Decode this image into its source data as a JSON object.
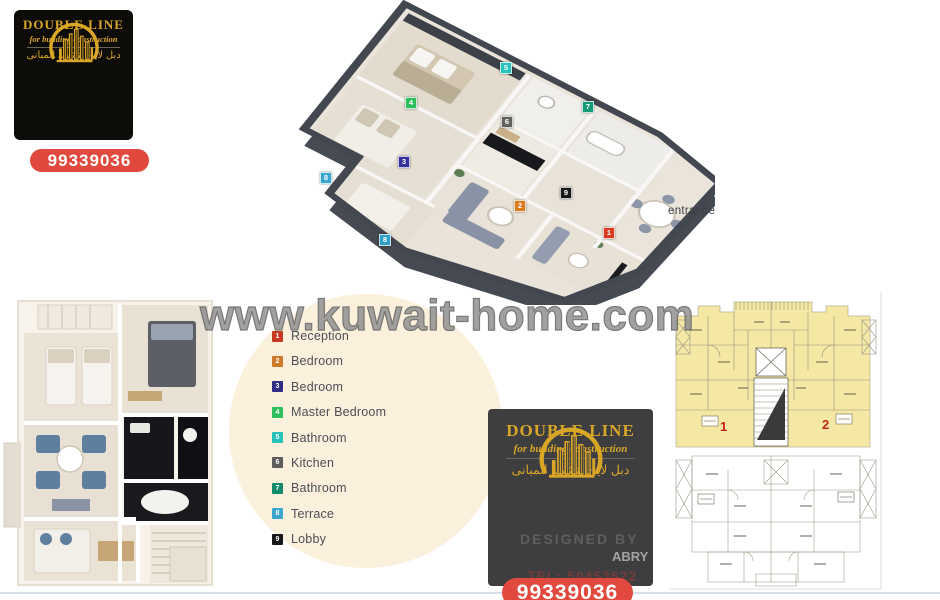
{
  "brand": {
    "name": "DOUBLE LINE",
    "tagline": "for building construction",
    "tagline_arabic": "دبل لاين لتشييد المبانى",
    "phone": "99339036",
    "gold_color": "#d9a625",
    "phone_bg_color": "#e2493e"
  },
  "watermark": "www.kuwait-home.com",
  "iso_plan": {
    "entrance_label": "entrance",
    "markers": [
      {
        "num": "1",
        "room": "Reception",
        "color": "#d93a20",
        "x": 609,
        "y": 233
      },
      {
        "num": "2",
        "room": "Bedroom",
        "color": "#dd7b22",
        "x": 520,
        "y": 206
      },
      {
        "num": "3",
        "room": "Bedroom",
        "color": "#33309e",
        "x": 404,
        "y": 162
      },
      {
        "num": "4",
        "room": "Master Bedroom",
        "color": "#2fbe5d",
        "x": 411,
        "y": 103
      },
      {
        "num": "5",
        "room": "Bathroom",
        "color": "#27c3bb",
        "x": 506,
        "y": 68
      },
      {
        "num": "6",
        "room": "Kitchen",
        "color": "#63625f",
        "x": 507,
        "y": 122
      },
      {
        "num": "7",
        "room": "Bathroom",
        "color": "#159a78",
        "x": 588,
        "y": 107
      },
      {
        "num": "8",
        "room": "Terrace",
        "color": "#3ba6d0",
        "x": 326,
        "y": 178
      },
      {
        "num": "8",
        "room": "Terrace",
        "color": "#2f9fc9",
        "x": 385,
        "y": 240
      },
      {
        "num": "9",
        "room": "Lobby",
        "color": "#17171a",
        "x": 566,
        "y": 193
      }
    ]
  },
  "legend": {
    "items": [
      {
        "num": "1",
        "label": "Reception",
        "color": "#c53a20"
      },
      {
        "num": "2",
        "label": "Bedroom",
        "color": "#cd7a28"
      },
      {
        "num": "3",
        "label": "Bedroom",
        "color": "#2f2c86"
      },
      {
        "num": "4",
        "label": "Master Bedroom",
        "color": "#2fbe5d"
      },
      {
        "num": "5",
        "label": "Bathroom",
        "color": "#27c3bb"
      },
      {
        "num": "6",
        "label": "Kitchen",
        "color": "#5d5c59"
      },
      {
        "num": "7",
        "label": "Bathroom",
        "color": "#128a6c"
      },
      {
        "num": "8",
        "label": "Terrace",
        "color": "#3ba6d0"
      },
      {
        "num": "9",
        "label": "Lobby",
        "color": "#17171a"
      }
    ]
  },
  "cad_plan": {
    "unit_1": "1",
    "unit_2": "2",
    "highlight_color": "#f4e8a4",
    "unit_number_color": "#c0251c"
  },
  "ghost_text": {
    "designer": "DESIGNED BY",
    "name_fragment": "ABRY",
    "tel_fragment": "TEL: 50453622"
  }
}
